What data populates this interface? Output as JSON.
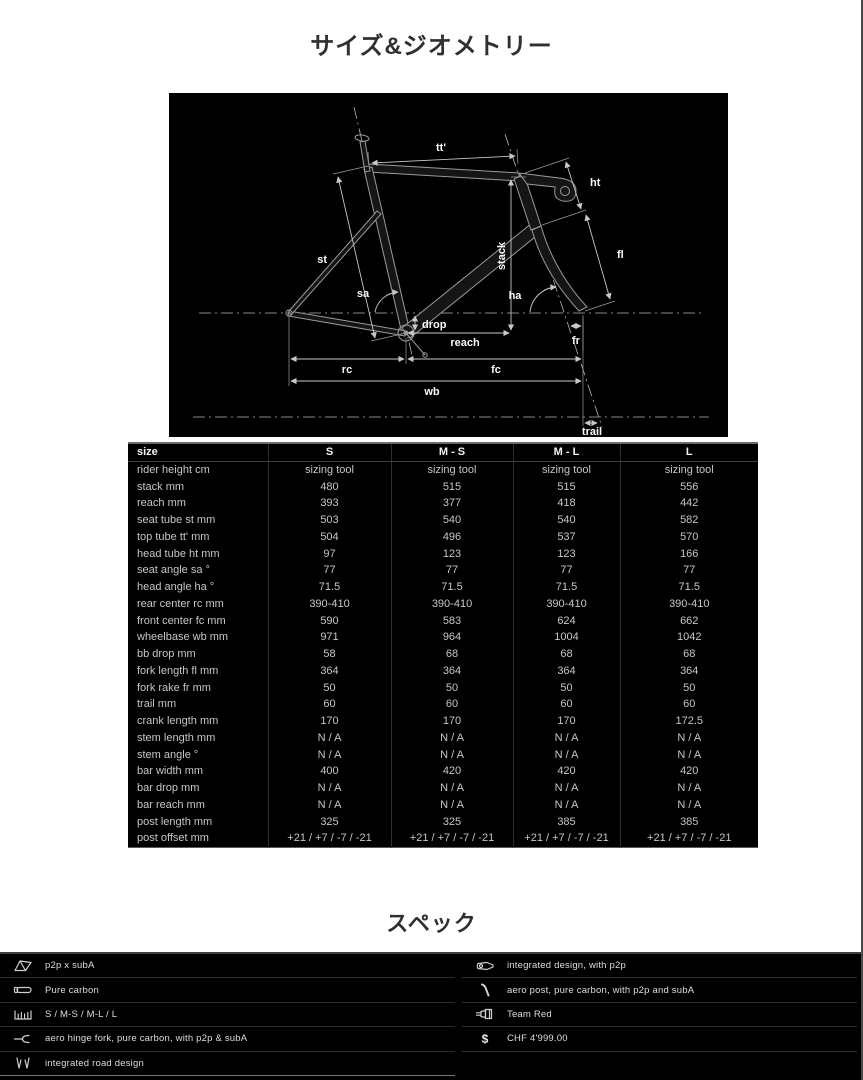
{
  "page": {
    "geometry_title": "サイズ&ジオメトリー",
    "spec_title": "スペック"
  },
  "colors": {
    "page_background": "#ffffff",
    "panel_background": "#000000",
    "table_text": "#c6c6c6",
    "header_text": "#f2f2f2",
    "title_text": "#303030",
    "separator": "#2e2e2e"
  },
  "diagram": {
    "labels": {
      "tt": "tt'",
      "ht": "ht",
      "fl": "fl",
      "st": "st",
      "stack": "stack",
      "sa": "sa",
      "ha": "ha",
      "drop": "drop",
      "reach": "reach",
      "fr": "fr",
      "rc": "rc",
      "fc": "fc",
      "wb": "wb",
      "trail": "trail"
    }
  },
  "size_table": {
    "columns": [
      "size",
      "S",
      "M - S",
      "M - L",
      "L"
    ],
    "rows": [
      {
        "label": "rider height cm",
        "values": [
          "sizing tool",
          "sizing tool",
          "sizing tool",
          "sizing tool"
        ]
      },
      {
        "label": "stack mm",
        "values": [
          "480",
          "515",
          "515",
          "556"
        ]
      },
      {
        "label": "reach mm",
        "values": [
          "393",
          "377",
          "418",
          "442"
        ]
      },
      {
        "label": "seat tube st mm",
        "values": [
          "503",
          "540",
          "540",
          "582"
        ]
      },
      {
        "label": "top tube tt' mm",
        "values": [
          "504",
          "496",
          "537",
          "570"
        ]
      },
      {
        "label": "head tube ht mm",
        "values": [
          "97",
          "123",
          "123",
          "166"
        ]
      },
      {
        "label": "seat angle sa °",
        "values": [
          "77",
          "77",
          "77",
          "77"
        ]
      },
      {
        "label": "head angle ha °",
        "values": [
          "71.5",
          "71.5",
          "71.5",
          "71.5"
        ]
      },
      {
        "label": "rear center rc mm",
        "values": [
          "390-410",
          "390-410",
          "390-410",
          "390-410"
        ]
      },
      {
        "label": "front center fc mm",
        "values": [
          "590",
          "583",
          "624",
          "662"
        ]
      },
      {
        "label": "wheelbase wb mm",
        "values": [
          "971",
          "964",
          "1004",
          "1042"
        ]
      },
      {
        "label": "bb drop mm",
        "values": [
          "58",
          "68",
          "68",
          "68"
        ]
      },
      {
        "label": "fork length fl mm",
        "values": [
          "364",
          "364",
          "364",
          "364"
        ]
      },
      {
        "label": "fork rake fr mm",
        "values": [
          "50",
          "50",
          "50",
          "50"
        ]
      },
      {
        "label": "trail mm",
        "values": [
          "60",
          "60",
          "60",
          "60"
        ]
      },
      {
        "label": "crank length mm",
        "values": [
          "170",
          "170",
          "170",
          "172.5"
        ]
      },
      {
        "label": "stem length mm",
        "values": [
          "N / A",
          "N / A",
          "N / A",
          "N / A"
        ]
      },
      {
        "label": "stem angle °",
        "values": [
          "N / A",
          "N / A",
          "N / A",
          "N / A"
        ]
      },
      {
        "label": "bar width mm",
        "values": [
          "400",
          "420",
          "420",
          "420"
        ]
      },
      {
        "label": "bar drop mm",
        "values": [
          "N / A",
          "N / A",
          "N / A",
          "N / A"
        ]
      },
      {
        "label": "bar reach mm",
        "values": [
          "N / A",
          "N / A",
          "N / A",
          "N / A"
        ]
      },
      {
        "label": "post length mm",
        "values": [
          "325",
          "325",
          "385",
          "385"
        ]
      },
      {
        "label": "post offset mm",
        "values": [
          "+21 / +7 / -7 / -21",
          "+21 / +7 / -7 / -21",
          "+21 / +7 / -7 / -21",
          "+21 / +7 / -7 / -21"
        ]
      }
    ]
  },
  "spec": {
    "left": [
      {
        "icon": "frame-icon",
        "label": "p2p x subA"
      },
      {
        "icon": "tube-icon",
        "label": "Pure carbon"
      },
      {
        "icon": "sizes-icon",
        "label": "S / M-S / M-L / L"
      },
      {
        "icon": "fork-icon",
        "label": "aero hinge fork, pure carbon, with p2p & subA"
      },
      {
        "icon": "seatstay-icon",
        "label": "integrated road design"
      }
    ],
    "right": [
      {
        "icon": "stem-icon",
        "label": "integrated design, with p2p"
      },
      {
        "icon": "seatpost-icon",
        "label": "aero post, pure carbon, with p2p and subA"
      },
      {
        "icon": "paint-icon",
        "label": "Team Red"
      },
      {
        "icon": "price-icon",
        "label": "CHF 4'999.00"
      }
    ]
  }
}
